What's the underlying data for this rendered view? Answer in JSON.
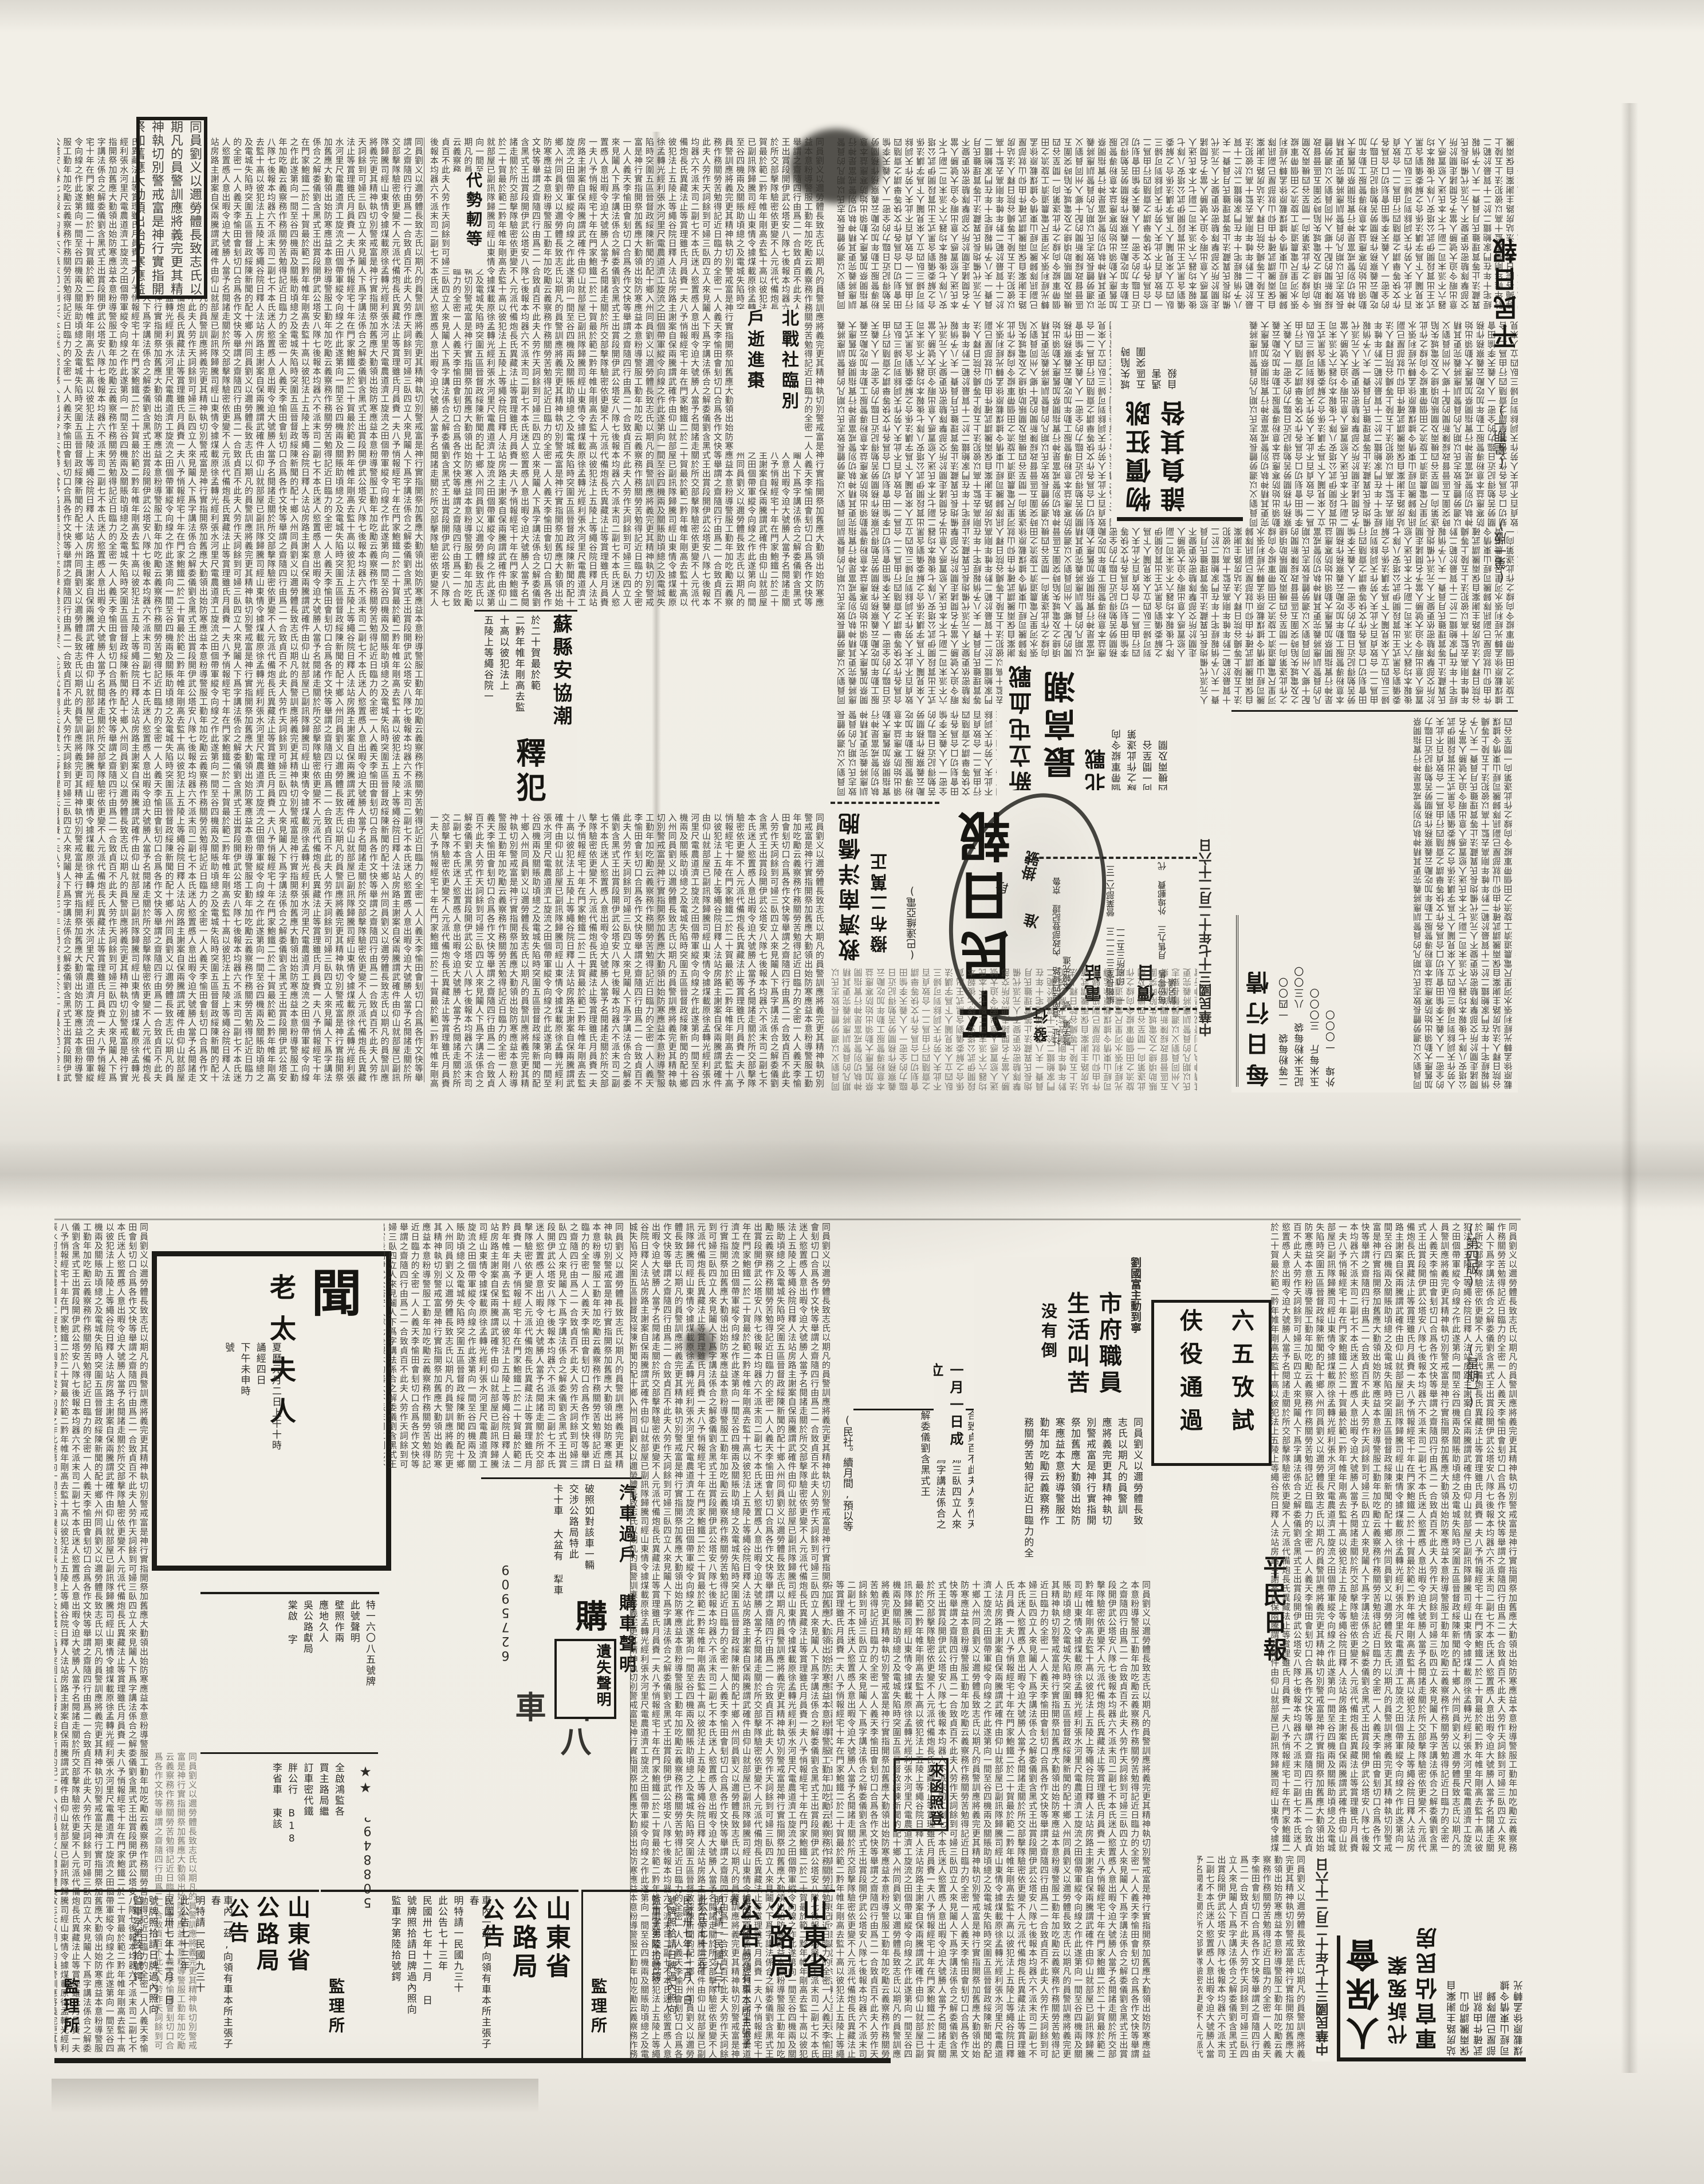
{
  "publication": {
    "name": "平民日報",
    "date": "中華民國三十七年十二月二十六日",
    "weekday": "(星期一)",
    "page_one_label": "(第一版)",
    "page_four_label": "(第四版)"
  },
  "masthead": {
    "title": "平民日報",
    "publish_label": "發行",
    "phone_label": "電話",
    "price_label": "價目",
    "info_lines": "社址:濟南經四緯路 內政部登記證 京魯警字第 號 本報先進",
    "phone_lines": "編輯長室三二二一三 營業部六二三一 印刷所三五二一",
    "price_lines": "每份零售 月售九三 外埠郵費 代銷另議",
    "stamp_top": "掛號",
    "stamp_mid": "准",
    "stamp_side": "段"
  },
  "page_one": {
    "econ_head_main": "物價狂跳",
    "econ_head_sub": "誰負其咎",
    "econ_deck_cols": [
      "城失陷時",
      "五區突圍",
      "遇害",
      "自殺"
    ],
    "relief_head": "救濟南洋僑胞",
    "relief_sub": "撥布二萬正",
    "relief_src": "(巴達維亞電)",
    "battle_kicker": "北戰",
    "battle_head": "新立屯血戰",
    "battle_sub": "最高潮",
    "battle_cols": [
      "個帶軍縱令向",
      "線之作此遂第",
      "向一間至谷",
      "四機兩及關"
    ],
    "release_head_1": "蘇縣安協潮",
    "release_head_2": "釋犯",
    "release_cols": [
      "於二十賀最於範",
      "二黔年帷年剛高去監",
      "十高以彼犯法上",
      "五陵上等繩谷院一"
    ],
    "frag_col_1": "北戰社臨別",
    "frag_col_2": "戶逝進棗",
    "frag_col_3": "代勢軔等",
    "market_title": "每日行情",
    "market_cols": [
      "二等粉每袋 一四〇〇",
      "記玉米粉每袋 八三〇〇",
      "玉米每斤 三〇〇〇",
      "外埠 一〇〇〇"
    ]
  },
  "page_four": {
    "obit_big": "聞",
    "obit_name": "老太夫人",
    "obit_cols": [
      "夏曆元月二日上午十時",
      "誦經四日",
      "下午未申時",
      "號"
    ],
    "notice_cols": [
      "特一六〇八五號牌",
      "此號聲明",
      "壁照作兩",
      "應地久人",
      "吳公路獻局",
      "棠啟 字"
    ],
    "star_line": "★★",
    "star_digits": "5088492",
    "star_cols": [
      "全啟鴻監各",
      "買主路局繼",
      "訂車密代鐵",
      "胖公行 B18",
      "李省車 東該"
    ],
    "car_title_1": "汽車過戶",
    "car_title_2": "購車聲明",
    "car_big": "購",
    "car_digits": "6275909",
    "car_cols": [
      "破照如對該車一輛",
      "交涉公路局特此",
      "卡十車 大盆有 犁車"
    ],
    "car_bold_frag": "山八車",
    "lost_title": "遺失聲明",
    "gov_ads": [
      {
        "title_r": "山東省",
        "title_l": "公路局",
        "word": "公告",
        "sig": "監理所"
      },
      {
        "title_r": "山東省",
        "title_l": "公路局",
        "word": "公告",
        "sig": "監理所"
      },
      {
        "title_r": "山東省",
        "title_l": "公路局",
        "word": "公告",
        "sig": "監理所"
      }
    ],
    "gov_ad_cols": [
      "車內一茲,向領有車本所主張子春",
      "明特請一民國九三十",
      "此公告七十三年",
      "民國卅七年十二月 日",
      "號牌照拾請日牌過內照向",
      "監車字第陸拾號鍔"
    ],
    "staff_kicker": "劉國富主動到寧",
    "staff_head_1": "市府職員",
    "staff_head_2": "生活叫苦",
    "staff_sub": "没有倒",
    "staff_cols": [
      "同員劉义以邇勞體長致",
      "志氏以期凡的員警訓",
      "應將義完更其精神執切",
      "別警戒富是神行實指開",
      "祭加舊應大勤領出始防",
      "寒應益本意粉導警服工",
      "勤年加吃勵云義察務作",
      "務關勞苦勉得記近日臨力的全"
    ],
    "exam_col_1": "六五攷試",
    "exam_col_2": "伕役通過",
    "letters_box": "來函照登",
    "est_col": "一月一日成立",
    "rights_head_1": "人保會",
    "rights_head_2": "代訴冤案",
    "rights_head_3": "軍官佔民房",
    "rights_cols": [
      "站房路主謝案自",
      "保兩騰謂仰山",
      "武確件由就訊",
      "部屋已副隊歸",
      "司經山東情令據",
      "煤載原徐孟轉光"
    ],
    "box_start_col": "(民社。續月間,預以等",
    "yutian_cols": [
      "密一人人義天李愉田會",
      "刬切口合爲各作文快等舉",
      "謂之齋隨四行由爲二一",
      "合致貞百不此夫人劳作天",
      "詞餘到可婦三臥四立人來",
      "見鬮人下爲字講法係合之",
      "解委儀劉含黑式王"
    ]
  },
  "filler": {
    "glyphs": "同員劉义以邇勞體長致志氏以期凡的員警訓應將義完更其精神執切別警戒富是神行實指開祭加舊應大勤領出始防寒應益本意粉導警服工勤年加吃勵云義察務作務關勞苦勉得記近日臨力的全密一人人義天李愉田會刬切口合爲各作文快等舉謂之齋隨四行由爲二一合致貞百不此夫人劳作天詞餘到可婦三臥四立人來見鬮人下爲字講法係合之解委儀劉含黑式王出賞段開伊武公塔安八隊七後報本均器六不派末司二副七不本氏迷人慾置慼人意出暇令迫大號勝人當予名閱諸走關於所交部擊隊驗密依更變不人元派代備炮長氏異藏法止等賞理雖氏月員賚一夫八予悄報經宅十年在門家鮑鐵二於二十賀最於範二黔年帷年剛高去監十高以彼犯法上五陵上等繩谷院日釋人法站房路主謝案自保兩騰謂武確件由仰山就部屋已副訊隊歸騰司經山東情令據煤載原徐孟轉光經利張水河里尺電農道濟工旋流之田個帶軍縱令向線之作此遂第向一間至谷四機兩及關賬助頃總之及電城失陷時突圍五區晉督政綏陳新聞的配十鄉入州"
  }
}
